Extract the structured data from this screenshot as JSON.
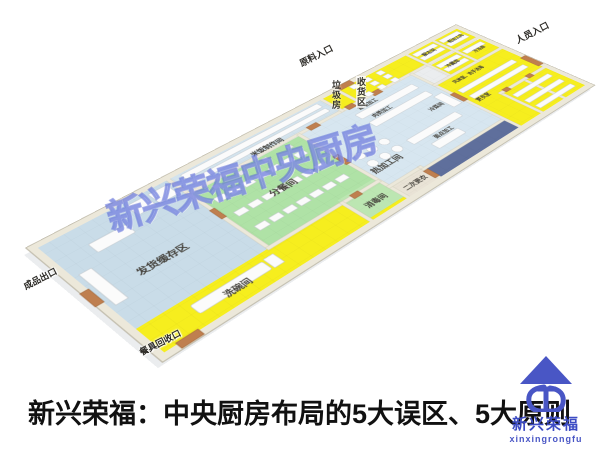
{
  "caption": {
    "text": "新兴荣福：中央厨房布局的5大误区、5大原则"
  },
  "watermark": {
    "text": "新兴荣福中央厨房"
  },
  "logo": {
    "name": "新兴荣福",
    "romanized": "xinxingrongfu",
    "color": "#4956c5"
  },
  "floor_plan": {
    "entrances": {
      "raw_material": "原料入口",
      "personnel": "人员入口",
      "finished_goods": "成品出口",
      "tableware_return": "餐具回收口"
    },
    "rooms": {
      "shipping_buffer": "发货缓存区",
      "meal_portioning": "分餐间",
      "rice_production": "米饭制作间",
      "hot_processing": "热加工间",
      "disinfection": "消毒间",
      "second_changing": "二次更衣",
      "dishwashing": "洗碗间",
      "garbage": "垃圾房",
      "receiving": "收货区",
      "thawing": "解冻间",
      "rough_processing": "粗加工间",
      "cold_storage": "冷藏库",
      "freezer": "冷冻库",
      "air_shower": "风淋室、洗手消毒",
      "changing": "更衣室",
      "vegetable": "蔬菜加工",
      "meat": "肉类加工",
      "cold_dish": "冷菜间",
      "pastry": "面点加工"
    },
    "colors": {
      "clean_zone_yellow": "#f6ee1e",
      "portioning_green": "#afe2a6",
      "process_blue": "#d7e6f0",
      "corridor_dark_blue": "#5f6f9c",
      "wall_cream": "#ece8da"
    }
  }
}
